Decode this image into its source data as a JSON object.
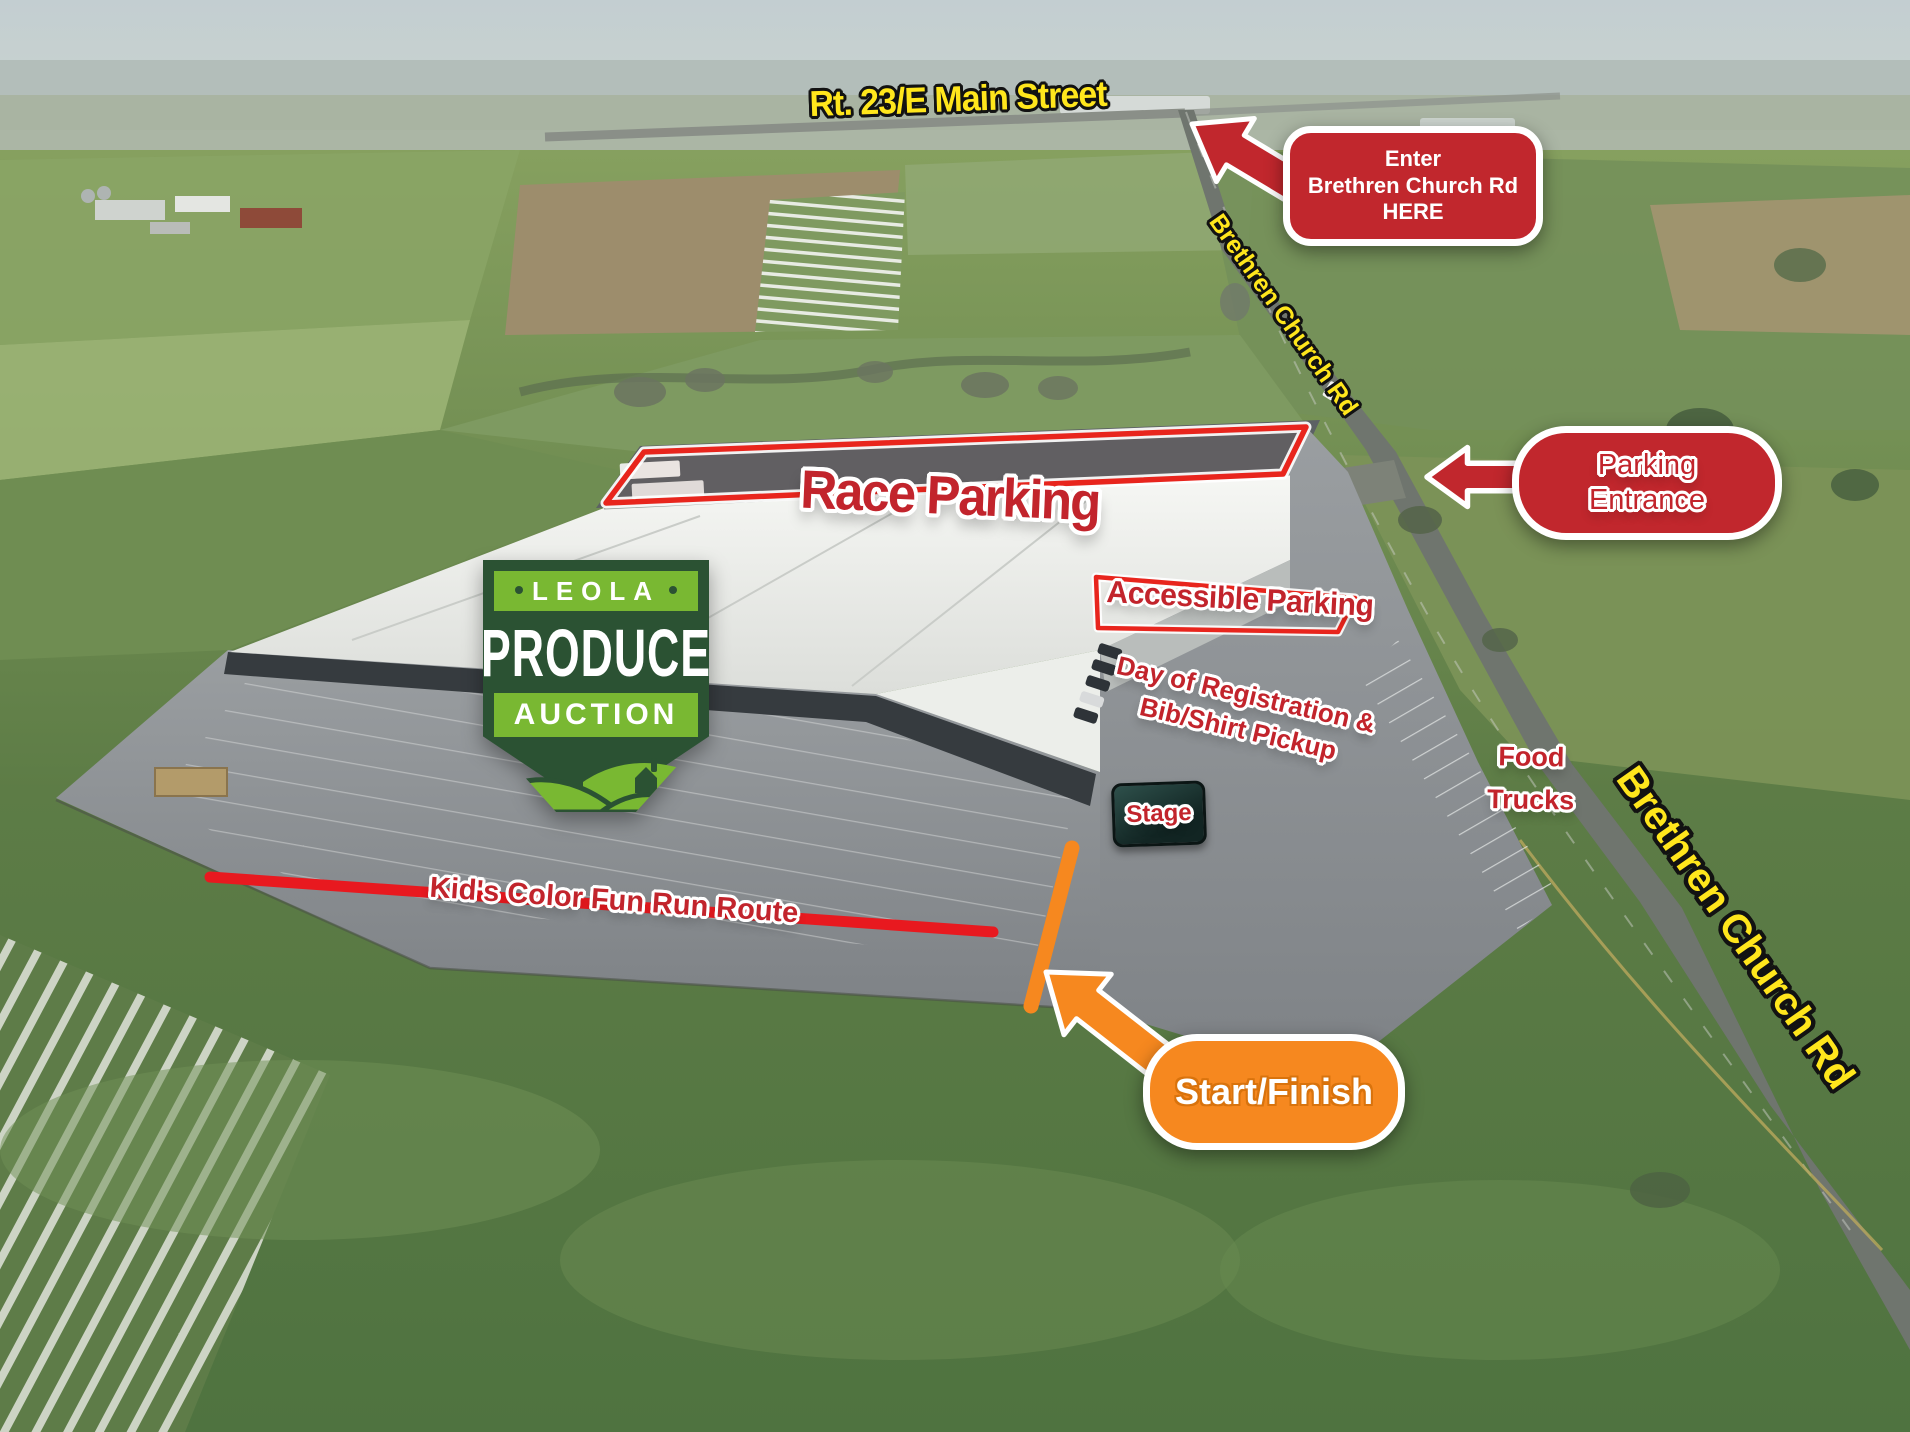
{
  "colors": {
    "callout_red": "#c1272d",
    "label_red": "#c2242c",
    "outline_red": "#e8251d",
    "road_label_yellow": "#ffe61c",
    "accent_orange": "#f6881f",
    "logo_dark_green": "#2b5233",
    "logo_light_green": "#79b832",
    "stage_sign_green": "#1d3b37"
  },
  "roads": {
    "rt23": "Rt. 23/E Main Street",
    "brethren_top": "Brethren Church Rd",
    "brethren_side": "Brethren Church Rd"
  },
  "callouts": {
    "enter": {
      "line1": "Enter",
      "line2": "Brethren Church Rd",
      "line3": "HERE"
    },
    "parking_entrance": {
      "line1": "Parking",
      "line2": "Entrance"
    },
    "start_finish": "Start/Finish"
  },
  "labels": {
    "race_parking": "Race Parking",
    "accessible_parking": "Accessible Parking",
    "registration": {
      "line1": "Day of Registration &",
      "line2": "Bib/Shirt Pickup"
    },
    "stage": "Stage",
    "food_trucks": {
      "line1": "Food",
      "line2": "Trucks"
    },
    "fun_run_route": "Kid's Color Fun Run Route"
  },
  "logo": {
    "name_top": "LEOLA",
    "name_mid": "PRODUCE",
    "name_bottom": "AUCTION"
  },
  "icons": {
    "enter_arrow": "arrow-up-left",
    "parking_entrance_arrow": "arrow-left",
    "start_finish_arrow": "arrow-up-left"
  }
}
